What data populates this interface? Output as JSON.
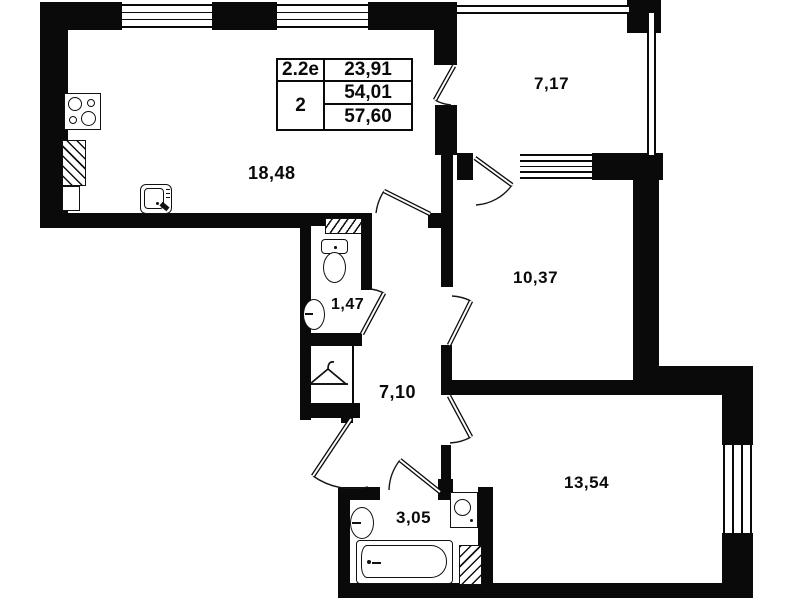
{
  "plan": {
    "kind": "apartment floor plan",
    "colors": {
      "wall": "#0a0a0a",
      "background": "#ffffff"
    },
    "info_table": {
      "plan_type": "2.2е",
      "rooms_count": "2",
      "area_row1": "23,91",
      "area_row2": "54,01",
      "area_row3": "57,60"
    },
    "room_labels": {
      "kitchen_living": "18,48",
      "loggia": "7,17",
      "bedroom": "10,37",
      "wc": "1,47",
      "hallway": "7,10",
      "living_room": "13,54",
      "bathroom": "3,05"
    },
    "fixture_icons": [
      "stove-icon",
      "kitchen-sink-icon",
      "vent-shaft-hatch",
      "toilet-icon",
      "washbasin-icon",
      "hanger-icon",
      "bathtub-icon",
      "washing-machine-icon"
    ]
  }
}
